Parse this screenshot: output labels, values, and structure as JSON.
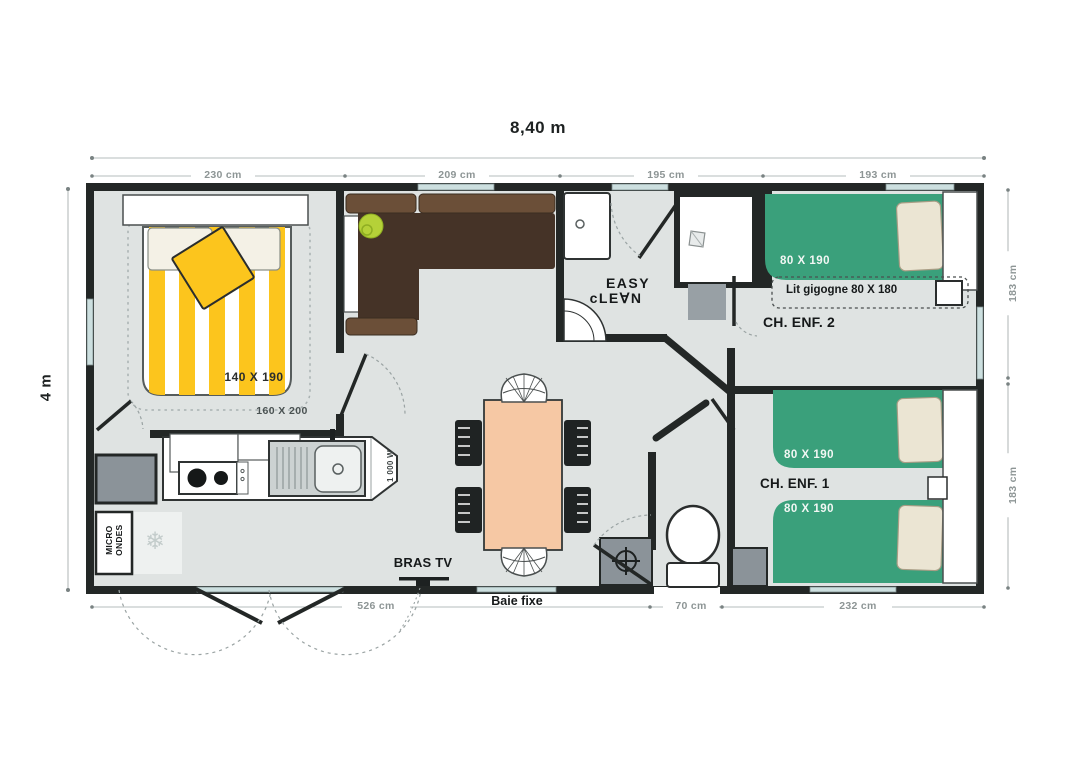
{
  "plan": {
    "overall_width_label": "8,40 m",
    "overall_height_label": "4 m",
    "top_dims": [
      "230 cm",
      "209 cm",
      "195 cm",
      "193 cm"
    ],
    "right_dims": [
      "183 cm",
      "183 cm"
    ],
    "bottom_dims": [
      "526 cm",
      "70 cm",
      "232 cm"
    ]
  },
  "master_bedroom": {
    "bed_size": "140 X 190",
    "bed_zone": "160 X 200"
  },
  "kitchen": {
    "microwave_label": "MICRO ONDES",
    "hob_power": "1 000 W"
  },
  "bathroom": {
    "logo_line1": "EASY",
    "logo_line2": "cLE∀N"
  },
  "living": {
    "tv_label": "BRAS TV",
    "bay_window_label": "Baie fixe"
  },
  "kids_room_2": {
    "name": "CH. ENF. 2",
    "bed_size": "80 X 190",
    "trundle_label": "Lit gigogne 80 X 180"
  },
  "kids_room_1": {
    "name": "CH. ENF. 1",
    "bed_top_size": "80 X 190",
    "bed_bottom_size": "80 X 190"
  },
  "icons": {
    "fridge_glyph": "❄",
    "fridge_icon": "snowflake-icon",
    "water_heater_icon": "crosshair-icon"
  },
  "colors": {
    "wall": "#232726",
    "floor": "#dfe3e2",
    "bed_green": "#3aa07b",
    "accent_yellow": "#fcc51d",
    "table_peach": "#f6c8a4",
    "sofa_brown": "#453327",
    "lime_green": "#b5d138",
    "glass": "#ccdfdf",
    "gray_unit": "#8b9399"
  }
}
